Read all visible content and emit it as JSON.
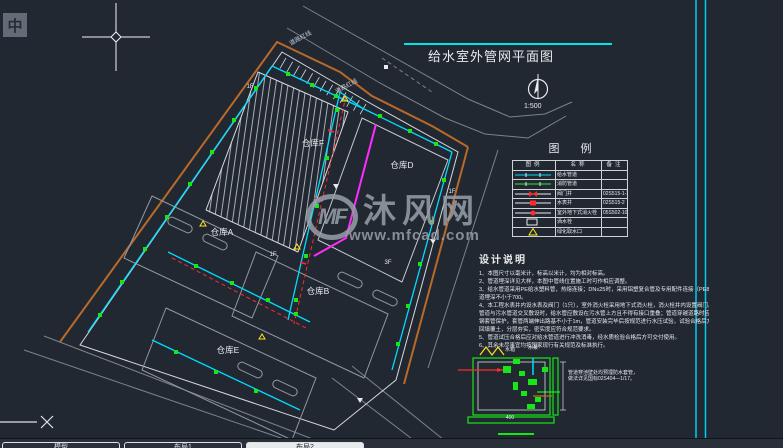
{
  "window": {
    "ime_button": "中"
  },
  "drawing": {
    "title": "给水室外管网平面图",
    "scale": "1:500",
    "road_label": "道路红线",
    "buildings": [
      {
        "label": "仓库F",
        "x": 313,
        "y": 143
      },
      {
        "label": "仓库D",
        "x": 402,
        "y": 165
      },
      {
        "label": "仓库A",
        "x": 222,
        "y": 232
      },
      {
        "label": "仓库B",
        "x": 318,
        "y": 291
      },
      {
        "label": "仓库E",
        "x": 228,
        "y": 350
      }
    ],
    "floor_labels": [
      {
        "label": "1F",
        "x": 250,
        "y": 87
      },
      {
        "label": "1F",
        "x": 273,
        "y": 255
      },
      {
        "label": "1F",
        "x": 452,
        "y": 192
      },
      {
        "label": "3F",
        "x": 388,
        "y": 263
      }
    ]
  },
  "legend": {
    "title": "图 例",
    "columns": [
      "图例",
      "名称",
      "备注"
    ],
    "rows": [
      {
        "symbol": "pipe-cyan",
        "name": "给水管道",
        "note": ""
      },
      {
        "symbol": "pipe-green",
        "name": "消防管道",
        "note": ""
      },
      {
        "symbol": "valve-well",
        "name": "阀门井",
        "note": "02S515-1-3"
      },
      {
        "symbol": "meter-well",
        "name": "水表井",
        "note": "02S515-2"
      },
      {
        "symbol": "hydrant",
        "name": "室外地下式消火栓",
        "note": "05S502-10"
      },
      {
        "symbol": "sprinkler",
        "name": "洒水栓",
        "note": ""
      },
      {
        "symbol": "green-tap",
        "name": "绿化取水口",
        "note": ""
      }
    ]
  },
  "notes": {
    "title": "设计说明",
    "lines": [
      "1、本图尺寸以毫米计，标高以米计，均为相对标高。",
      "2、管道埋深详见大样，本图中管线位置施工时可作相应调整。",
      "3、给水管道采用PE给水塑料管，热熔连接；DN≤25时，采用铝塑复合管及专用配件连接（PE80），管",
      "    道埋深不小于700。",
      "4、本工程水表井内设水表及阀门（1只），室外消火栓采用地下式消火栓，消火栓井内设置阀门。给水",
      "    管道与污水管道交叉敷设时，给水管应敷设在污水管上方且不得有接口重叠；管道穿越道路时应加设",
      "    钢套管保护，套管两端伸出路基不小于1m，管道安装完毕后按规范进行水压试验，试验合格后方可",
      "    回填覆土，分层夯实，密实度应符合规范要求。",
      "5、管道试压合格后应对给水管道进行冲洗消毒，经水质检验合格后方可交付使用。",
      "6、其余未尽事宜均按国家现行有关规范及标准执行。"
    ]
  },
  "detail": {
    "labels": [
      {
        "text": "水箱",
        "x": 510,
        "y": 353
      },
      {
        "text": "水泵",
        "x": 533,
        "y": 351
      },
      {
        "text": "400",
        "x": 510,
        "y": 421
      }
    ],
    "note_lines": [
      "管道穿池壁处均预埋防水套管，",
      "做法详见国标02S404—1/17。"
    ]
  },
  "watermark": {
    "logo": "MF",
    "name": "沐风网",
    "url": "www.mfcad.com"
  },
  "tabs": [
    {
      "label": "模型",
      "active": false
    },
    {
      "label": "布局1",
      "active": false
    },
    {
      "label": "布局2",
      "active": true
    }
  ],
  "colors": {
    "pipe_water": "#00dcff",
    "pipe_fire": "#2ee62e",
    "boundary": "#b96a28",
    "valve": "#17e617",
    "highlight": "#ff2cff",
    "annotation": "#ff2a2a",
    "title_underline": "#00e5e5"
  }
}
